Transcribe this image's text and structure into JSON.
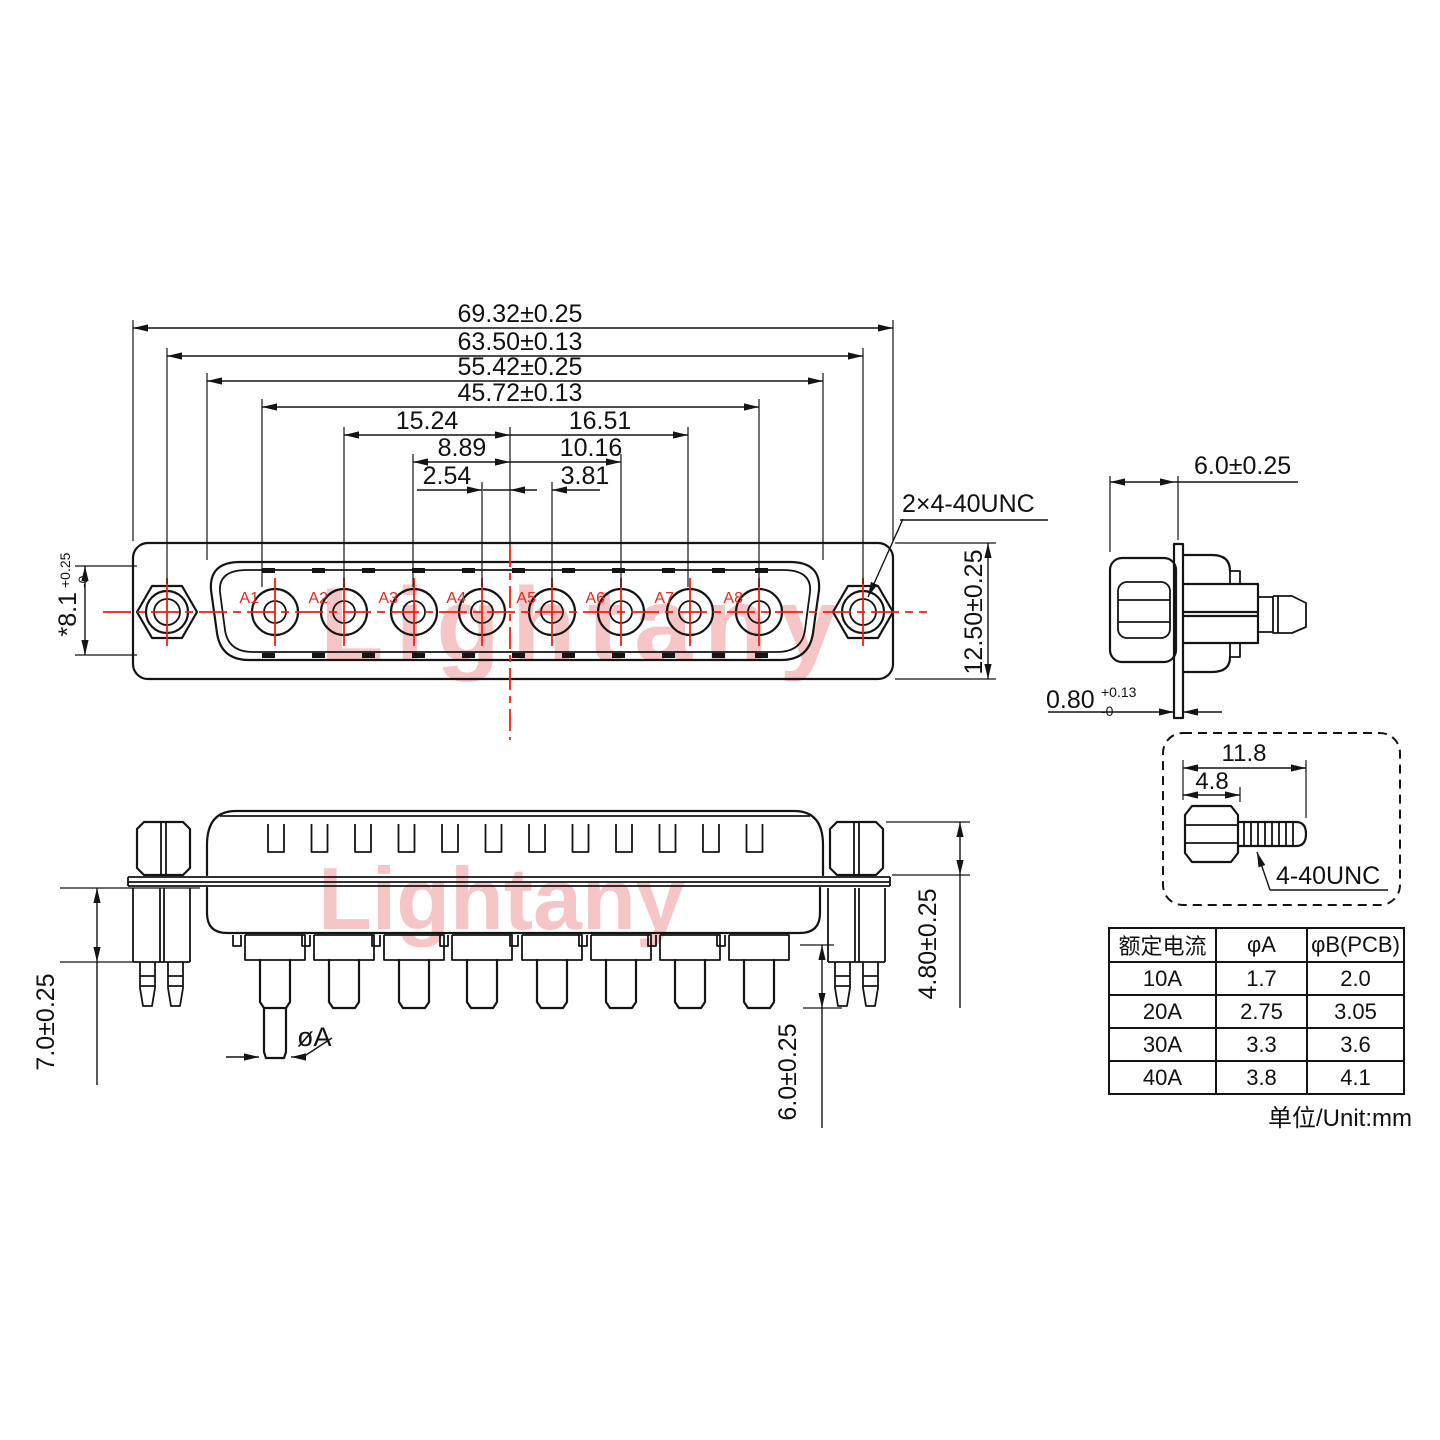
{
  "brand_watermark": "Lightany",
  "front_view": {
    "pin_labels": [
      "A1",
      "A2",
      "A3",
      "A4",
      "A5",
      "A6",
      "A7",
      "A8"
    ],
    "dim_total_width": "69.32±0.25",
    "dim_mount_spacing": "63.50±0.13",
    "dim_shell_width": "55.42±0.25",
    "dim_contact_span": "45.72±0.13",
    "dim_a2_to_center": "15.24",
    "dim_center_to_a7": "16.51",
    "dim_a3_to_center": "8.89",
    "dim_center_to_a6": "10.16",
    "dim_a4_to_center": "2.54",
    "dim_center_to_a5": "3.81",
    "dim_shell_height_main": "*8.1",
    "dim_shell_height_sup": "+0.25",
    "dim_shell_height_sub": "-0",
    "dim_flange_height": "12.50±0.25",
    "thread_callout": "2×4-40UNC"
  },
  "side_view": {
    "dim_depth": "6.0±0.25",
    "dim_flange_thk_main": "0.80",
    "dim_flange_thk_sup": "+0.13",
    "dim_flange_thk_sub": "-0"
  },
  "bottom_view": {
    "dim_standoff_length": "7.0±0.25",
    "dim_nut_height": "4.80±0.25",
    "dim_pin_length": "6.0±0.25",
    "dim_pin_diameter": "øA"
  },
  "screw_detail": {
    "dim_total_length": "11.8",
    "dim_hex_length": "4.8",
    "thread_label": "4-40UNC"
  },
  "spec_table": {
    "headers": [
      "额定电流",
      "φA",
      "φB(PCB)"
    ],
    "rows": [
      [
        "10A",
        "1.7",
        "2.0"
      ],
      [
        "20A",
        "2.75",
        "3.05"
      ],
      [
        "30A",
        "3.3",
        "3.6"
      ],
      [
        "40A",
        "3.8",
        "4.1"
      ]
    ],
    "unit_note": "单位/Unit:mm"
  }
}
